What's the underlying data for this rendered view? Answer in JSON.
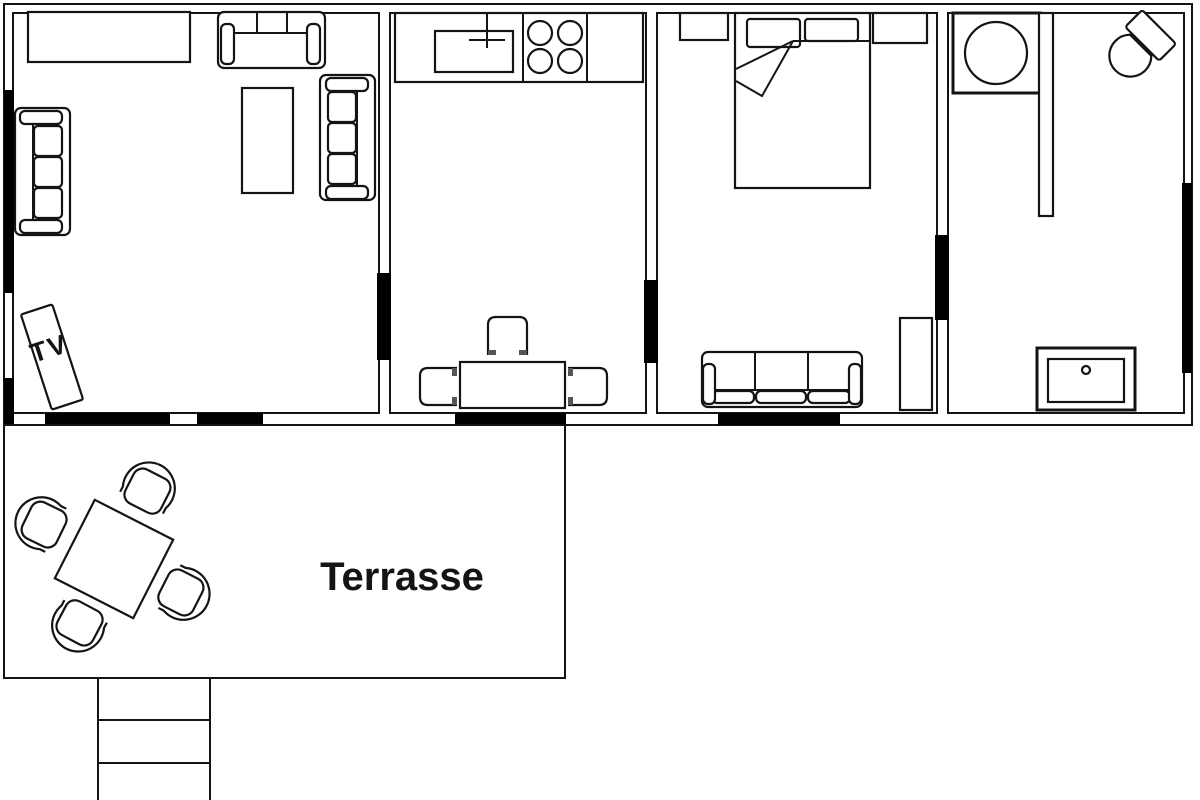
{
  "labels": {
    "terrace": "Terrasse",
    "tv": "TV"
  },
  "colors": {
    "line": "#141414",
    "background": "#ffffff",
    "opening_fill": "#000000"
  }
}
